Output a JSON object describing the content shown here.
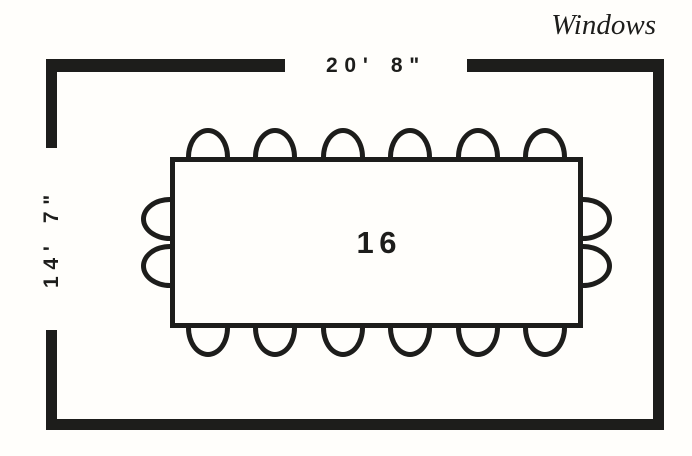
{
  "room": {
    "windows_label": "Windows",
    "width_dimension": "20' 8\"",
    "height_dimension": "14' 7\""
  },
  "table": {
    "seat_count": "16",
    "seats": {
      "top": 6,
      "bottom": 6,
      "left": 2,
      "right": 2
    }
  },
  "colors": {
    "ink": "#1d1d1b",
    "background": "#fffefb"
  }
}
